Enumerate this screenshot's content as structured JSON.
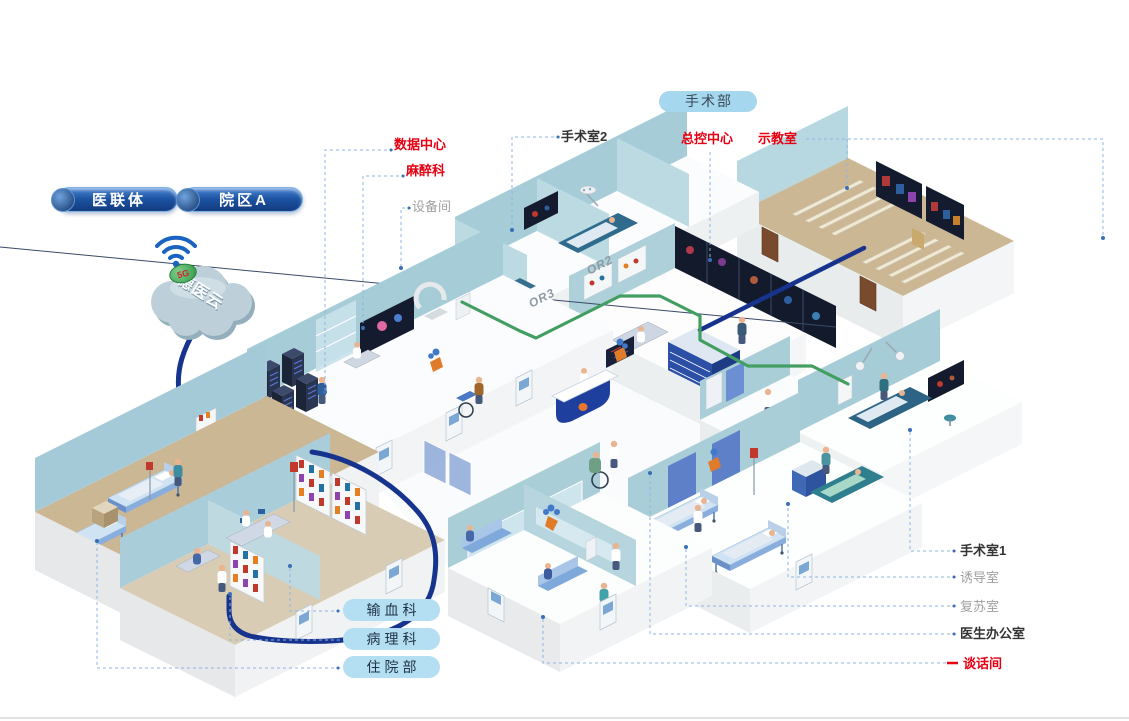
{
  "colors": {
    "accent_red": "#e60012",
    "dark_label": "#333333",
    "gray_label": "#9fa0a0",
    "connector_blue": "#8fb4e3",
    "cable_navy": "#16338e",
    "cable_green": "#439e62",
    "pill_blue_bg": "#b4def1",
    "surgery_pill_bg": "#a5d7ee",
    "button_navy": "#1b4f9e",
    "cloud_fill": "#bdd0da",
    "wall_teal": "#a6ccd7",
    "floor_tan": "#ccb795"
  },
  "top_buttons": [
    {
      "label": "医联体"
    },
    {
      "label": "院区A"
    }
  ],
  "cloud": {
    "name": "德医云",
    "badge": "5G"
  },
  "surgery_pill": {
    "label": "手术部"
  },
  "callouts": [
    {
      "label": "数据中心",
      "style": "red"
    },
    {
      "label": "麻醉科",
      "style": "red"
    },
    {
      "label": "设备间",
      "style": "gray"
    },
    {
      "label": "手术室2",
      "style": "dark"
    },
    {
      "label": "总控中心",
      "style": "red"
    },
    {
      "label": "示教室",
      "style": "red"
    },
    {
      "label": "手术室1",
      "style": "dark"
    },
    {
      "label": "诱导室",
      "style": "gray"
    },
    {
      "label": "复苏室",
      "style": "gray"
    },
    {
      "label": "医生办公室",
      "style": "dark"
    },
    {
      "label": "谈话间",
      "style": "red"
    }
  ],
  "department_pills": [
    {
      "label": "输血科"
    },
    {
      "label": "病理科"
    },
    {
      "label": "住院部"
    }
  ],
  "floor_labels": {
    "or2": "OR2",
    "or3": "OR3"
  }
}
